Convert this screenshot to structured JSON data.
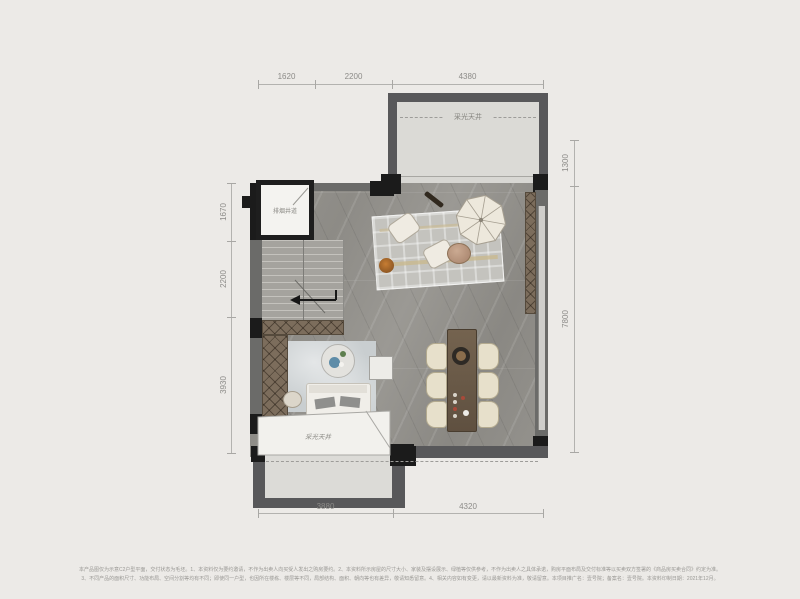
{
  "floorplan": {
    "rooms": {
      "lightwell_top_label": "采光天井",
      "shaft_label": "排烟井道",
      "lightwell_bottom_label": "采光天井"
    },
    "dimensions": {
      "top": [
        "1620",
        "2200",
        "4380"
      ],
      "bottom": [
        "3880",
        "4320"
      ],
      "left": [
        "1670",
        "2200",
        "3930"
      ],
      "right": [
        "1300",
        "7800"
      ]
    },
    "footer": {
      "line1": "本产品图仅为示意C2户型平面，交付状态为毛坯。1、本资料仅为要约邀请，不作为出卖人向买受人发出之购房要约。2、本资料所示房屋的尺寸大小、家装及摆设展示、绿植等仅供参考，不作为出卖人之具体承诺，购房平面布局及交付标准等以买卖双方签署的《商品房买卖合同》约定为准。",
      "line2": "3、不同产品的面积尺寸、功能布局、空间分割等均有不同；即使同一户型，也因所在楼栋、楼层等不同，局部结构、面积、朝向等也有差异，敬请知悉留意。4、相关内容如有变更，请以最新资料为准，敬请留意。本项目推广名：壹号院；备案名：壹号院。本资料印制日期：2021年12月。"
    },
    "colors": {
      "background": "#ECEAE7",
      "wall_dark": "#58585A",
      "wall_black": "#1B1B1B",
      "floor_marble": "#96948E",
      "lightwell_fill": "#DBDAD6",
      "wood_closet": "#7C6D5C",
      "dining_table": "#6A5A48",
      "dim_text": "#8C8B88"
    }
  }
}
